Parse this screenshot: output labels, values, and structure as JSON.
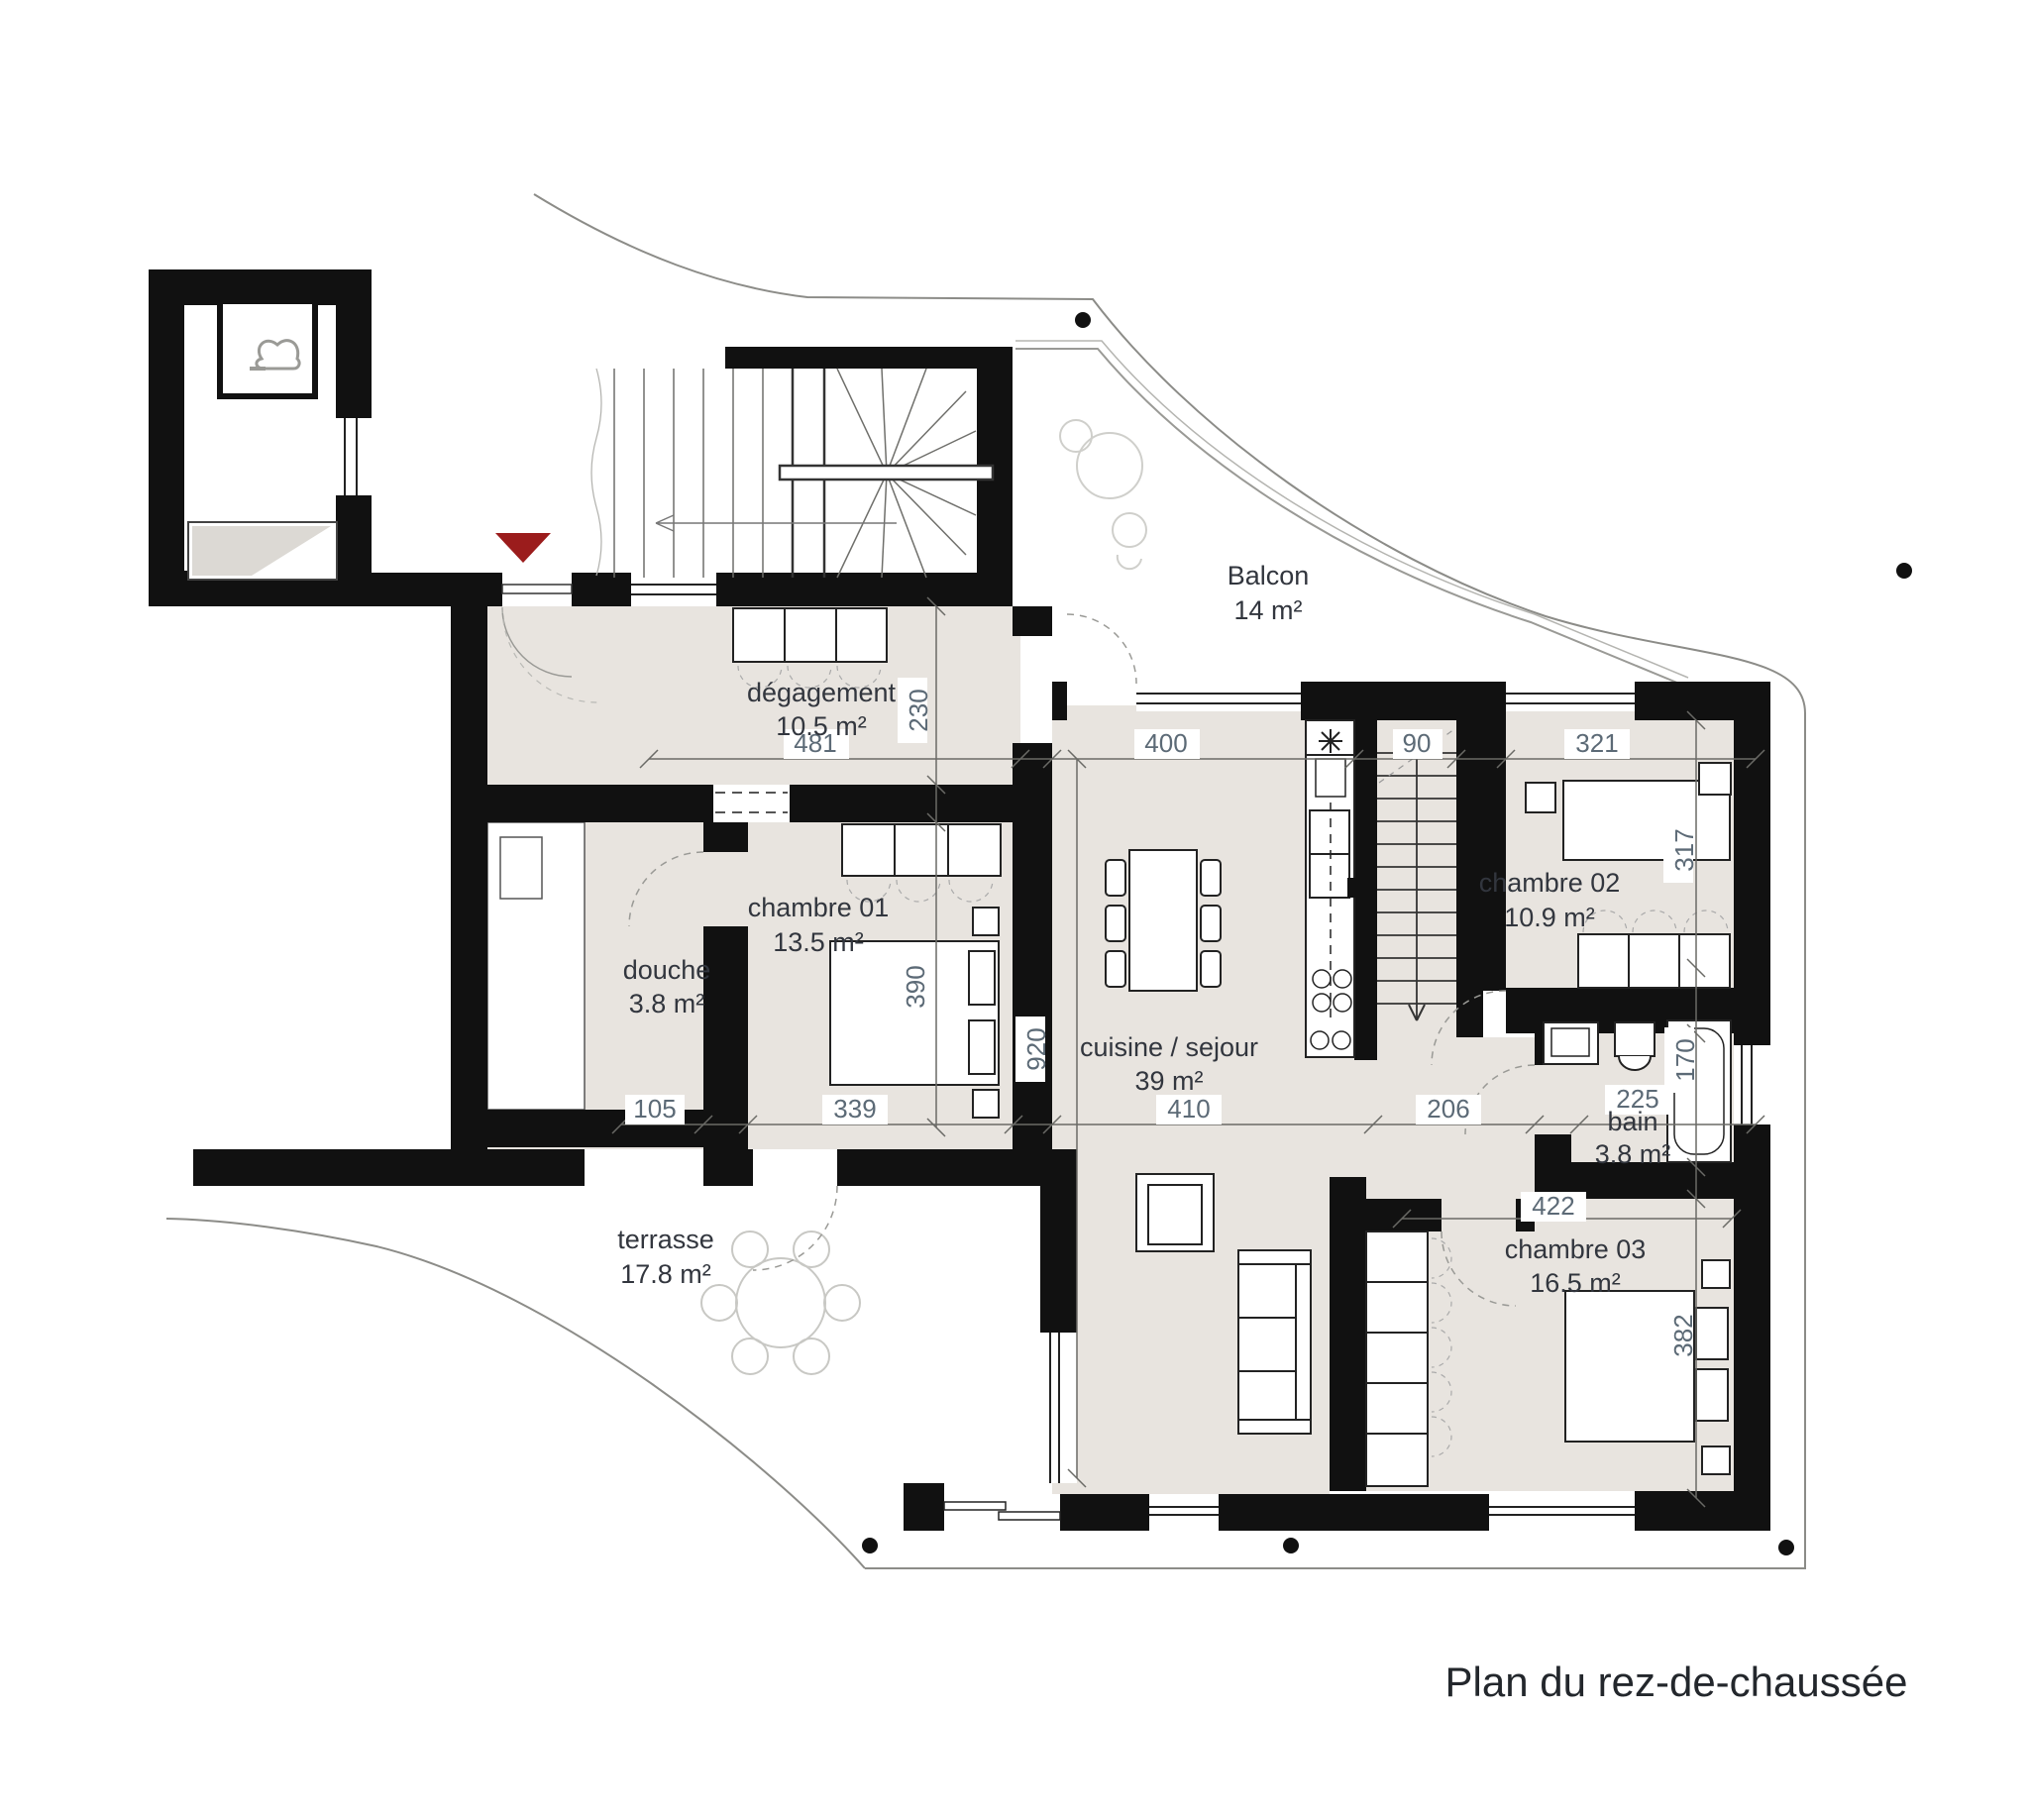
{
  "title": "Plan du rez-de-chaussée",
  "rooms": {
    "balcon": {
      "name": "Balcon",
      "area": "14 m²"
    },
    "degagement": {
      "name": "dégagement",
      "area": "10.5 m²"
    },
    "chambre01": {
      "name": "chambre 01",
      "area": "13.5 m²"
    },
    "douche": {
      "name": "douche",
      "area": "3.8 m²"
    },
    "cuisine": {
      "name": "cuisine / sejour",
      "area": "39 m²"
    },
    "chambre02": {
      "name": "chambre 02",
      "area": "10.9 m²"
    },
    "bain": {
      "name": "bain",
      "area": "3.8 m²"
    },
    "chambre03": {
      "name": "chambre 03",
      "area": "16.5 m²"
    },
    "terrasse": {
      "name": "terrasse",
      "area": "17.8 m²"
    }
  },
  "dimensions": {
    "deg_w": "481",
    "deg_h": "230",
    "cuisine_top_w": "400",
    "stair_w": "90",
    "ch02_w": "321",
    "ch02_h": "317",
    "ch01_h": "390",
    "sejour_h": "920",
    "douche_w": "105",
    "ch01_w": "339",
    "sejour_w": "410",
    "passage_w": "206",
    "bain_w": "225",
    "bain_h": "170",
    "ch03_w": "422",
    "ch03_h": "382"
  },
  "colors": {
    "wall": "#111111",
    "room_fill": "#e8e4df",
    "dim_text": "#5c6a76",
    "entrance_marker": "#9b1c1c"
  }
}
